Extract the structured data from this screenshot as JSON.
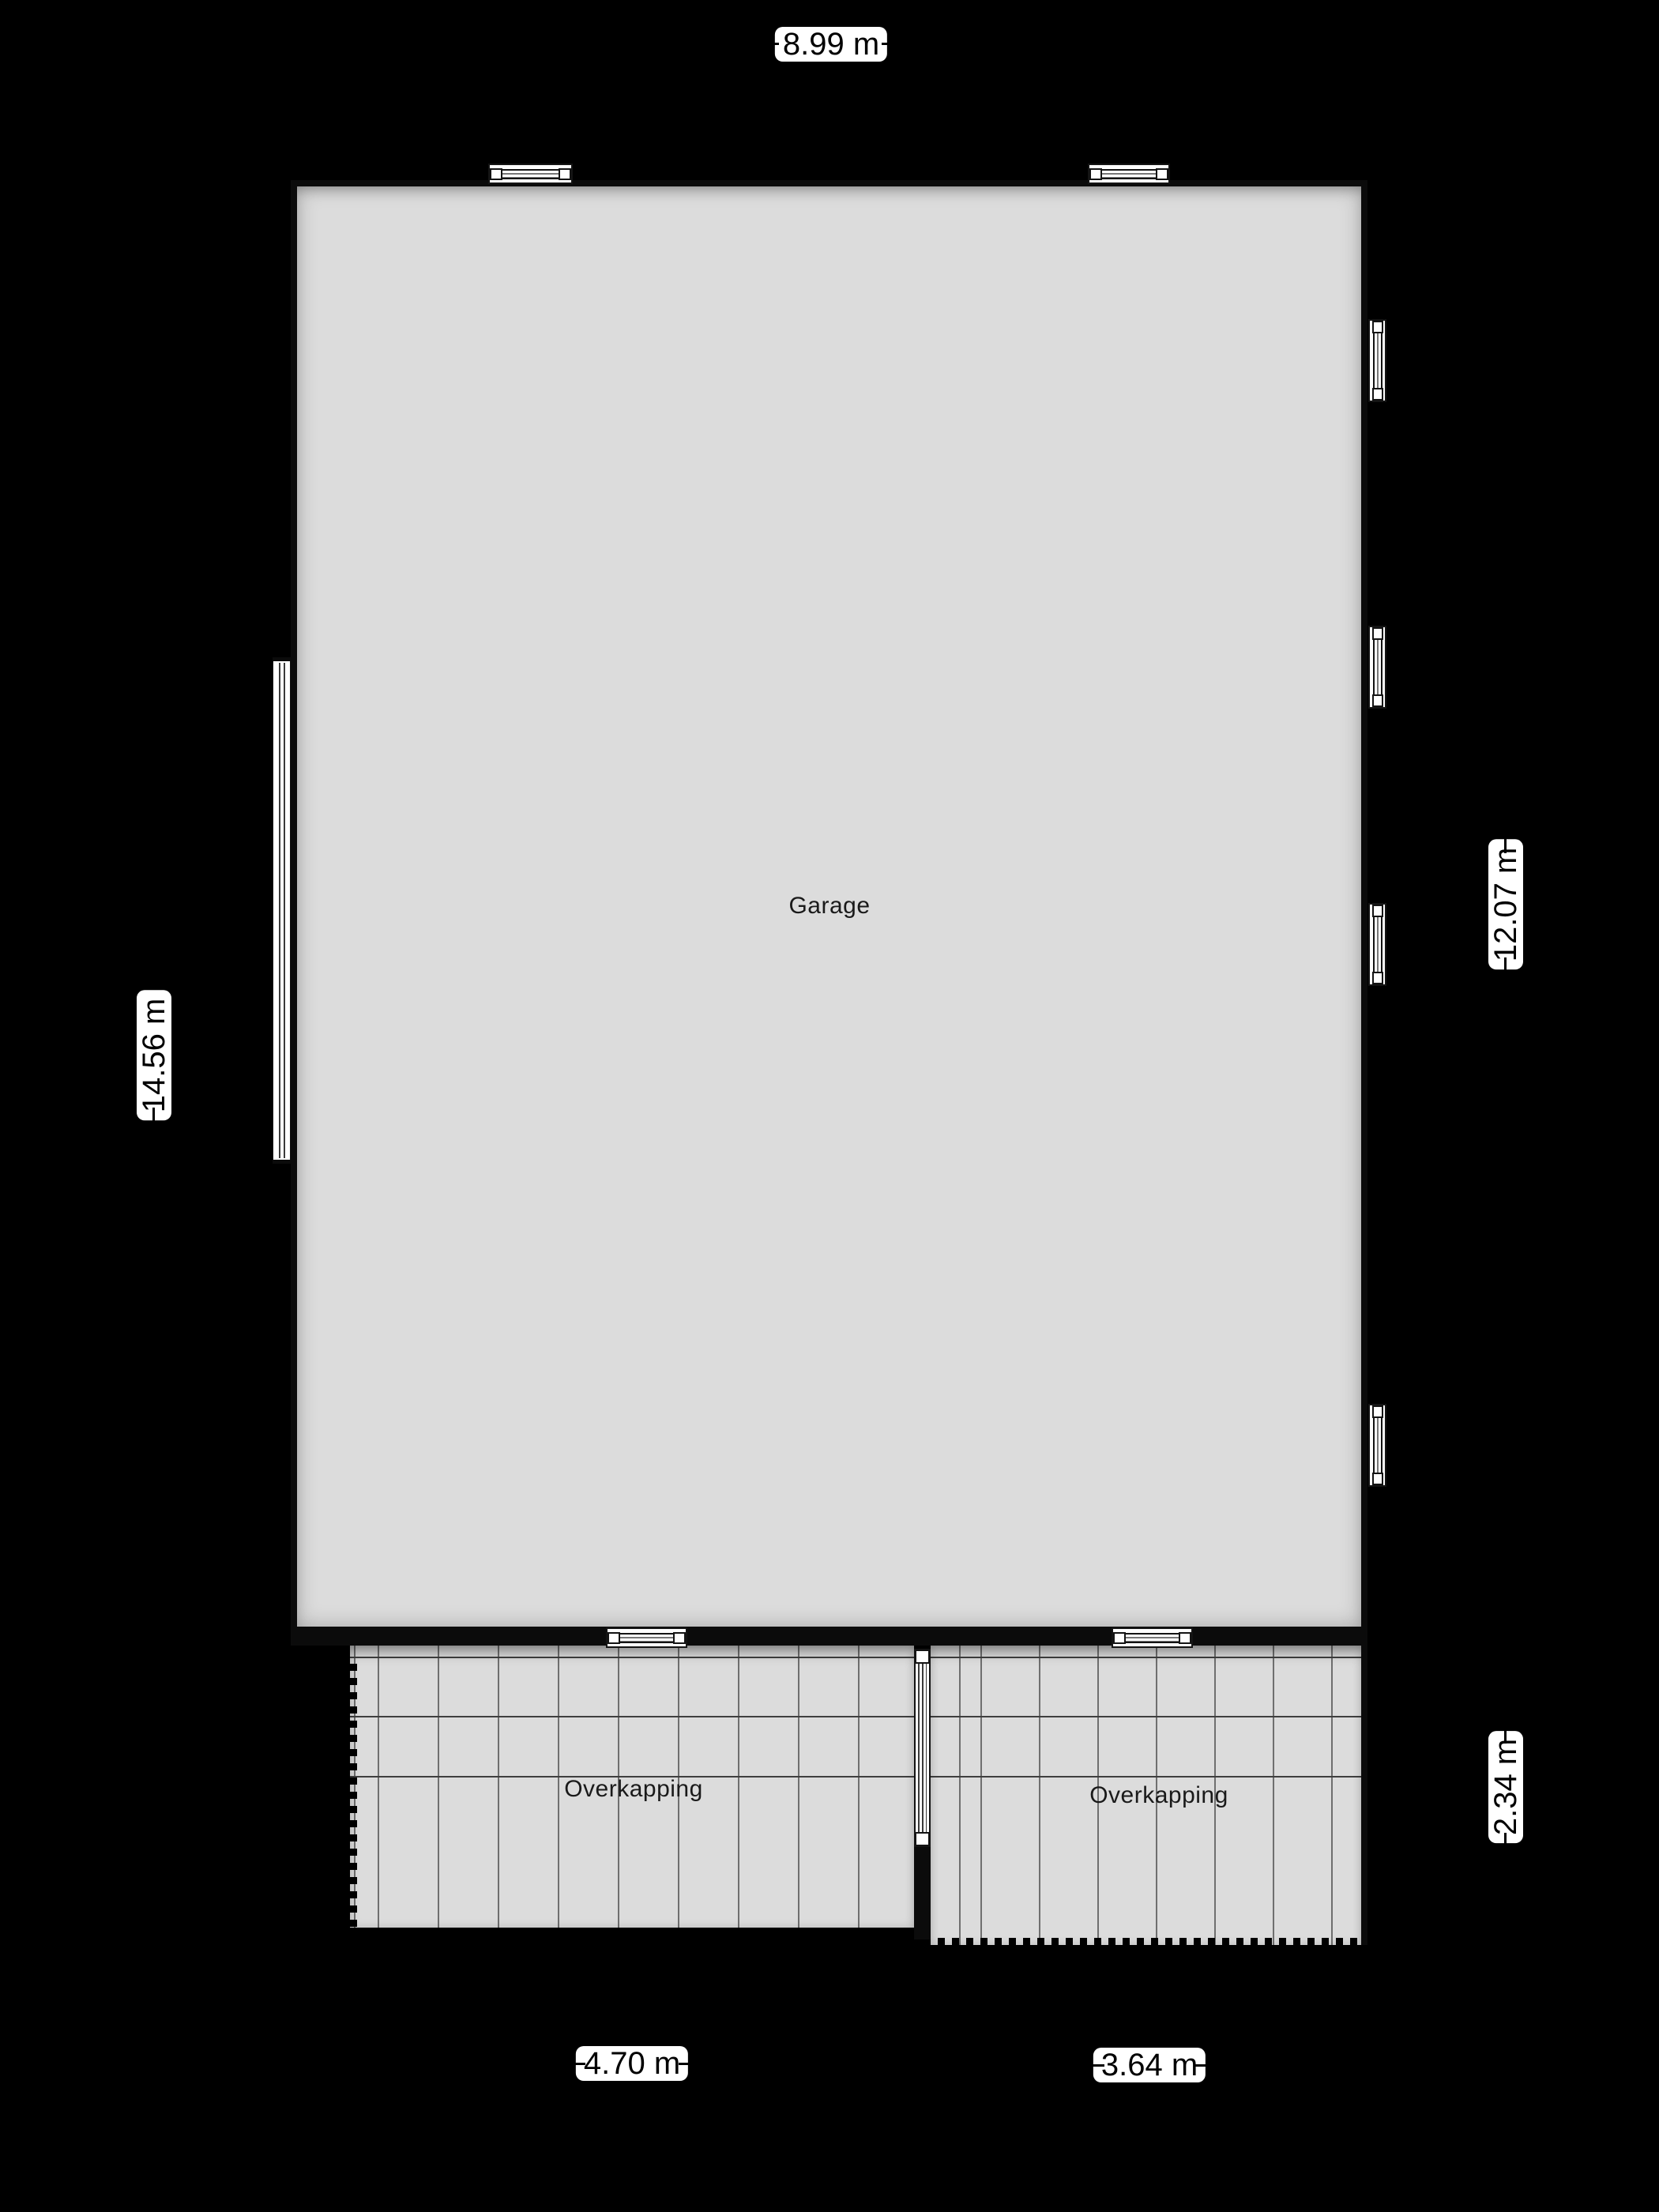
{
  "plan": {
    "rooms": {
      "garage": "Garage",
      "overkapping_left": "Overkapping",
      "overkapping_right": "Overkapping"
    },
    "dimensions": {
      "top": "8.99 m",
      "left": "14.56 m",
      "right_upper": "12.07 m",
      "right_lower": "2.34 m",
      "bottom_left": "4.70 m",
      "bottom_right": "3.64 m"
    },
    "colors": {
      "background": "#000000",
      "wall": "#0b0b0b",
      "floor": "#dcdcdc",
      "grid_line": "#6f6f6f",
      "beam_line": "#3f3f3f",
      "label_background": "#ffffff",
      "label_text": "#000000",
      "room_text": "#1a1a1a"
    }
  }
}
